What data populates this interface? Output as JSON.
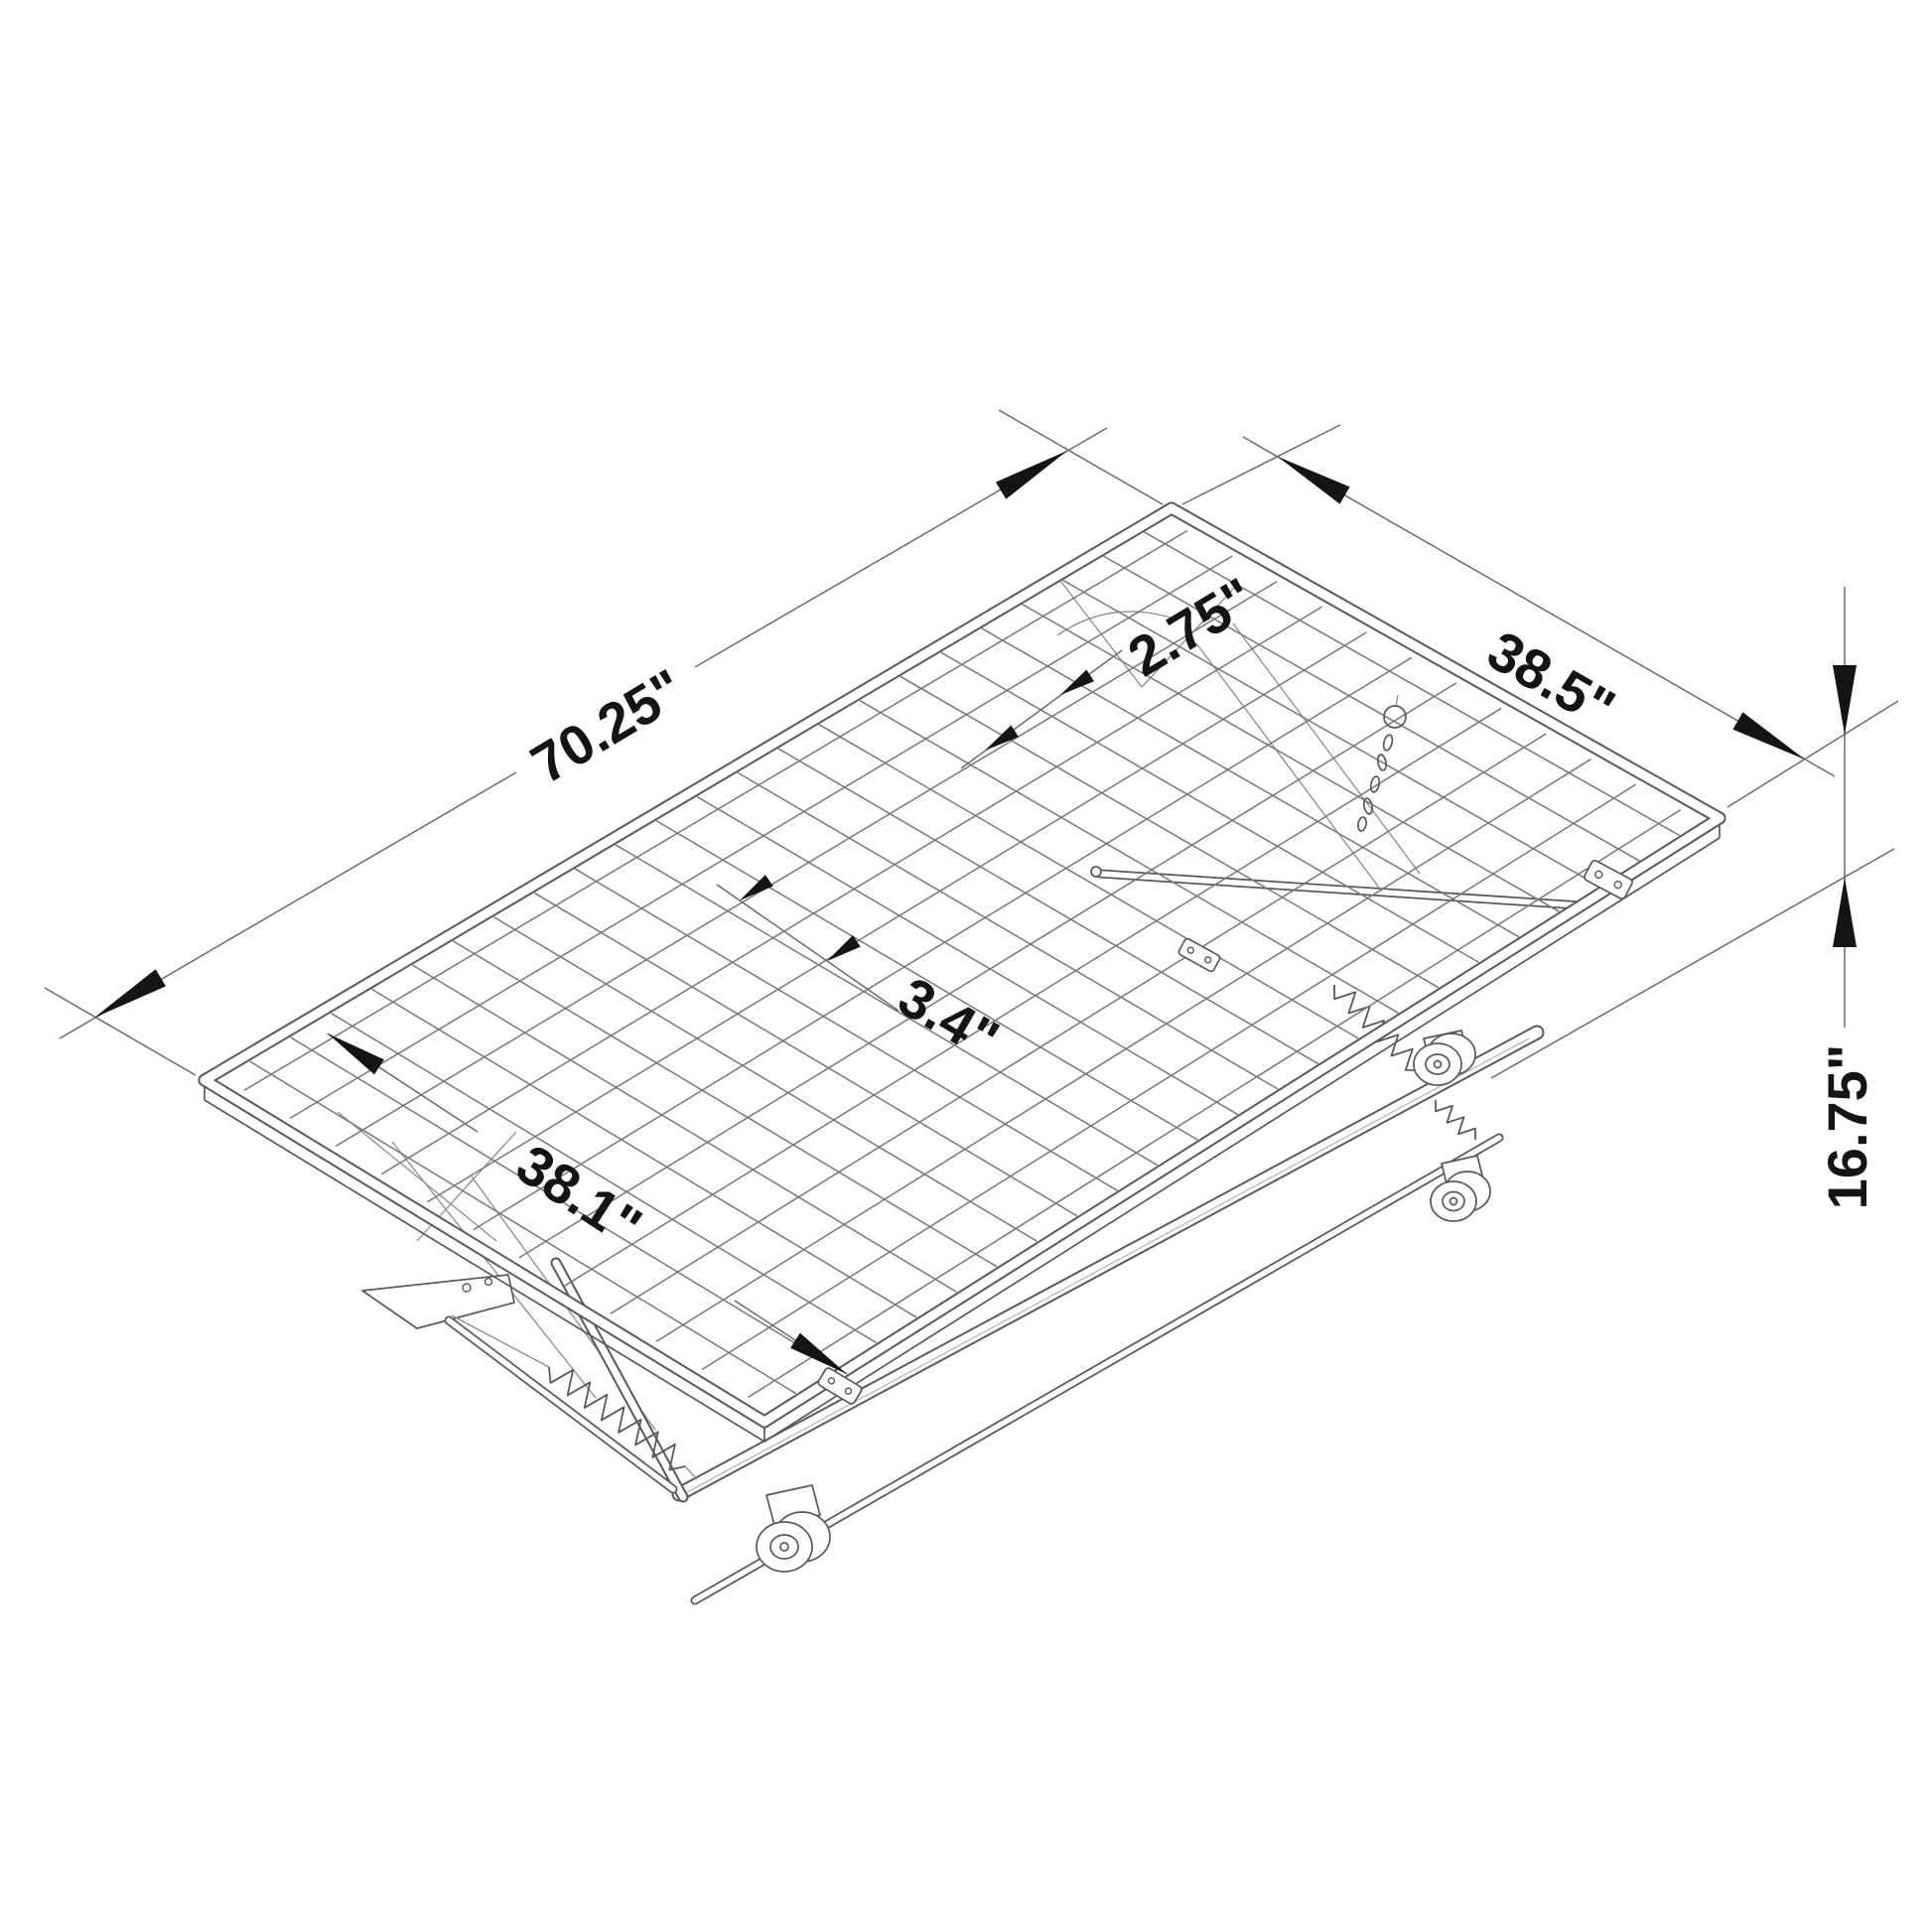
{
  "diagram": {
    "background": "#ffffff",
    "colors": {
      "line": "#58595b",
      "wire": "#76777a",
      "dim": "#6a6b6d",
      "text": "#141414"
    },
    "mesh": {
      "cross_wires": 23,
      "long_wires": 12
    },
    "dimensions": {
      "length": "70.25\"",
      "width": "38.5\"",
      "cross_wire_spacing": "2.75\"",
      "long_wire_spacing": "3.4\"",
      "inner_width": "38.1\"",
      "height": "16.75\""
    }
  }
}
